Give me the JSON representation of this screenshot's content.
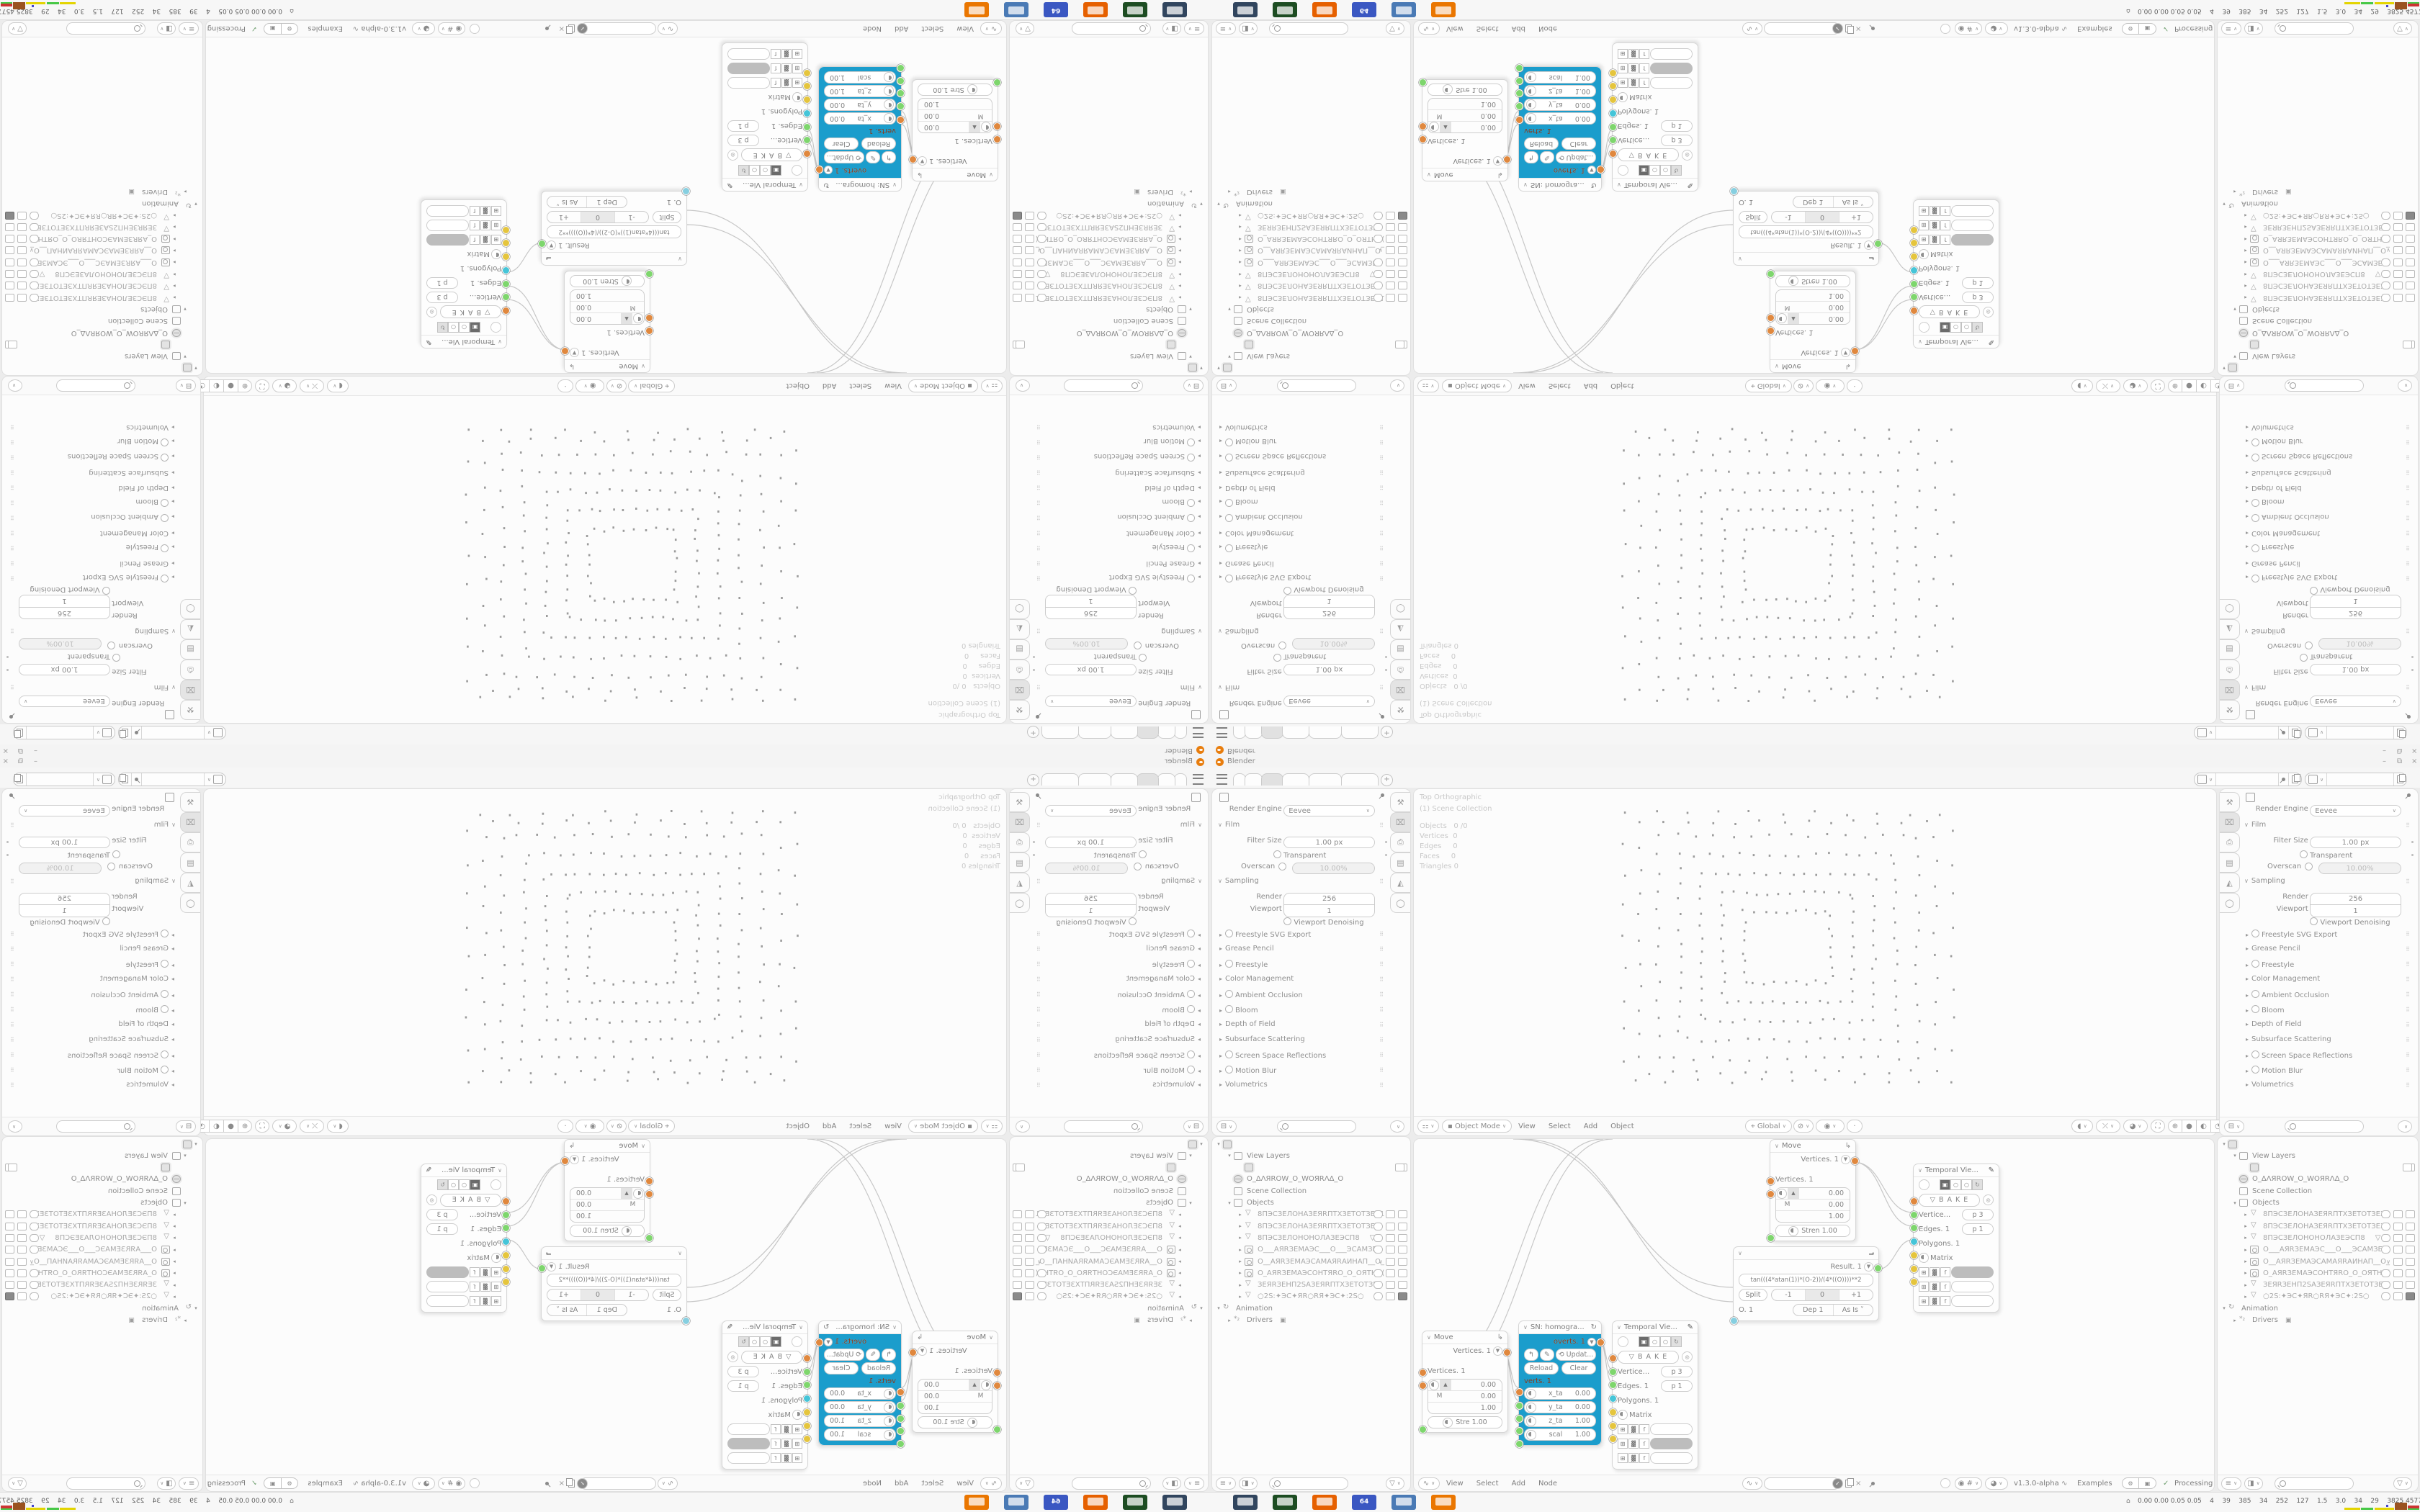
{
  "window": {
    "title": "Blender",
    "controls": {
      "minimize": "–",
      "maximize": "⧉",
      "close": "×"
    }
  },
  "tabbar": {
    "tabs": [
      "",
      "",
      "",
      "",
      "",
      ""
    ],
    "active_index": 2,
    "new_tab": "+"
  },
  "properties": {
    "engine_label": "Render Engine",
    "engine_value": "Eevee",
    "rows": [
      {
        "type": "sectionO",
        "label": "Film"
      },
      {
        "type": "field",
        "label": "Filter Size",
        "value": "1.00 px",
        "dot": true
      },
      {
        "type": "check",
        "label": "Transparent",
        "dot": true
      },
      {
        "type": "checkfield",
        "label": "Overscan",
        "value": "10.00%"
      },
      {
        "type": "sectionO",
        "label": "Sampling"
      },
      {
        "type": "stack",
        "label": "Render",
        "value": "256"
      },
      {
        "type": "stack2",
        "label": "Viewport",
        "value": "1"
      },
      {
        "type": "check",
        "label": "Viewport Denoising",
        "center": true
      },
      {
        "type": "section",
        "check": true,
        "label": "Freestyle SVG Export"
      },
      {
        "type": "section",
        "label": "Grease Pencil"
      },
      {
        "type": "section",
        "check": true,
        "label": "Freestyle"
      },
      {
        "type": "section",
        "label": "Color Management"
      },
      {
        "type": "section",
        "check": true,
        "label": "Ambient Occlusion"
      },
      {
        "type": "section",
        "check": true,
        "label": "Bloom"
      },
      {
        "type": "section",
        "label": "Depth of Field"
      },
      {
        "type": "section",
        "label": "Subsurface Scattering"
      },
      {
        "type": "section",
        "check": true,
        "label": "Screen Space Reflections"
      },
      {
        "type": "section",
        "check": true,
        "label": "Motion Blur"
      },
      {
        "type": "section",
        "label": "Volumetrics"
      }
    ],
    "tabs": [
      "tool",
      "render",
      "output",
      "view-layer",
      "scene",
      "world"
    ],
    "active_tab": 1
  },
  "viewport": {
    "overlay": [
      "Top Orthographic",
      "(1) Scene Collection"
    ],
    "stats": [
      [
        "Objects",
        "0 /0"
      ],
      [
        "Vertices",
        "0"
      ],
      [
        "Edges",
        "0"
      ],
      [
        "Faces",
        "0"
      ],
      [
        "Triangles",
        "0"
      ]
    ],
    "header": {
      "mode": "Object Mode",
      "menus": [
        "View",
        "Select",
        "Add",
        "Object"
      ],
      "orientation": "Global"
    }
  },
  "outliner": {
    "scene_rows": [
      {
        "arrow": "▾",
        "icon": "data",
        "boxed": true,
        "label": "",
        "indent": 0
      },
      {
        "arrow": "▾",
        "icon": "img",
        "label": "View Layers",
        "dark": true,
        "indent": 1
      },
      {
        "icon": "img",
        "boxed": true,
        "label": "",
        "indent": 2,
        "right": [
          "cam"
        ]
      },
      {
        "icon": "globe",
        "boxed": true,
        "label": "O_ΔΛЯROW_O_WOЯRΛΔ_O",
        "dark": true,
        "indent": 1
      },
      {
        "icon": "box",
        "label": "Scene Collection",
        "dark": true,
        "indent": 1
      },
      {
        "arrow": "▾",
        "icon": "box",
        "label": "Objects",
        "dark": true,
        "indent": 1
      },
      {
        "arrow": "▸",
        "icon": "mesh",
        "label": "8ПЭСЗЕЛОНАЗЕЯRПТХЗЕТОТЗЕХ1",
        "indent": 2,
        "right": [
          "eye",
          "scr",
          "cam"
        ]
      },
      {
        "arrow": "▸",
        "icon": "mesh",
        "label": "8ПЭСЗЕЛОНАЗЕЯRПТХЗЕТОТЗЕХ",
        "indent": 2,
        "right": [
          "eye",
          "scr",
          "cam"
        ]
      },
      {
        "arrow": "▸",
        "icon": "mesh",
        "label": "8ПЭСЗЕЛОНОНОЛАЗЕЭСП8",
        "extra": "▽",
        "indent": 2,
        "right": [
          "eye",
          "scr",
          "cam"
        ]
      },
      {
        "arrow": "▸",
        "icon": "cam",
        "label": "O___АЯRЗЕМАЭС___O___ЭСАМЗЕ",
        "indent": 2,
        "right": [
          "eye",
          "scr",
          "cam"
        ]
      },
      {
        "arrow": "▸",
        "icon": "cam",
        "label": "O__АЯRЗЕМАЭСАМАЯRАИНАП__O_",
        "indent": 2,
        "right": [
          "chev",
          "scr",
          "cam"
        ]
      },
      {
        "arrow": "▸",
        "icon": "cam",
        "label": "O_АЯRЗЕМАЭСОНТЯRО_O_ОЯТНС(",
        "indent": 2,
        "right": [
          "eye",
          "scr",
          "cam"
        ]
      },
      {
        "arrow": "▸",
        "icon": "mesh",
        "label": "ЗЕЯRЗЕНП2SАЗЕЯRПТХЗЕТОТЗЕ)",
        "indent": 2,
        "right": [
          "eye",
          "scr",
          "cam"
        ]
      },
      {
        "arrow": "▸",
        "icon": "mesh",
        "label": "○2S:✦ЭС✦ЯR○RЯ✦ЭС✦:2S○",
        "indent": 2,
        "right": [
          "eye",
          "scr",
          "camfill"
        ]
      },
      {
        "arrow": "▾",
        "icon": "anim",
        "label": "Animation",
        "dark": true,
        "indent": 0
      },
      {
        "arrow": "▸",
        "icon": "drv",
        "label": "Drivers",
        "dark": true,
        "suffix": "▣",
        "indent": 1
      }
    ]
  },
  "node_editor": {
    "menus": [
      "View",
      "Select",
      "Add",
      "Node"
    ],
    "version": "v1.3.0-alpha",
    "examples": "Examples",
    "status": "Processing",
    "nodes": {
      "move": {
        "title": "Move",
        "out_label": "Vertices. 1",
        "in_label": "Vertices. 1",
        "vec": [
          "0.00",
          "0.00",
          "1.00"
        ],
        "m_label": "M",
        "strength_a": "Stren  1.00",
        "strength_b": "Stre  1.00"
      },
      "sn": {
        "title": "SN: homogra...",
        "out_label": "overts. 1",
        "update": "Updat...",
        "reload": "Reload",
        "clear": "Clear",
        "in_label": "verts. 1",
        "fields": [
          [
            "x_ta",
            "0.00"
          ],
          [
            "y_ta",
            "0.00"
          ],
          [
            "z_ta",
            "1.00"
          ],
          [
            "scal",
            "1.00"
          ]
        ]
      },
      "temporal": {
        "title": "Temporal Vie...",
        "bake": "B A K E",
        "sockets": [
          [
            "Vertice...",
            "p  3",
            "orange"
          ],
          [
            "Edges. 1",
            "p  1",
            "green"
          ],
          [
            "Polygons. 1",
            "",
            "green"
          ],
          [
            "Matrix",
            "",
            "cyan"
          ]
        ]
      },
      "formula": {
        "result_label": "Result. 1",
        "formula": "tan(((4*atan(1))*(O-2))/(4*((O))))**2",
        "split": "Split",
        "minus": "-1",
        "zero": "0",
        "plus": "+1",
        "o_label": "O. 1",
        "dep": "Dep  1",
        "asis": "As Is"
      }
    }
  },
  "taskbar": {
    "apps": [
      {
        "name": "screen-monitor",
        "color": "#31455e"
      },
      {
        "name": "terminal",
        "color": "#1d4d22"
      },
      {
        "name": "firefox",
        "color": "#e66000"
      },
      {
        "name": "save-64",
        "color": "#3a57c2",
        "label": "64"
      },
      {
        "name": "image-viewer",
        "color": "#4a7ab5"
      },
      {
        "name": "blender-app",
        "color": "#ea7600"
      }
    ],
    "stats": "0.00 0.00 0.05 0.05    4    39    385    34    252    127    1.5    3.0    34    29    3825 4577",
    "tray_colors": [
      "#e3d400",
      "#46c846",
      "#e3d400",
      "#9a5220",
      "#cc3333"
    ]
  },
  "colors": {
    "accent_blue": "#1b9dcc",
    "socket_orange": "#e0883e",
    "socket_green": "#7ed66d",
    "socket_cyan": "#45c5d8",
    "socket_yellow": "#e5c53d",
    "socket_blue": "#86cfe0",
    "blender_orange": "#e87d0d"
  }
}
